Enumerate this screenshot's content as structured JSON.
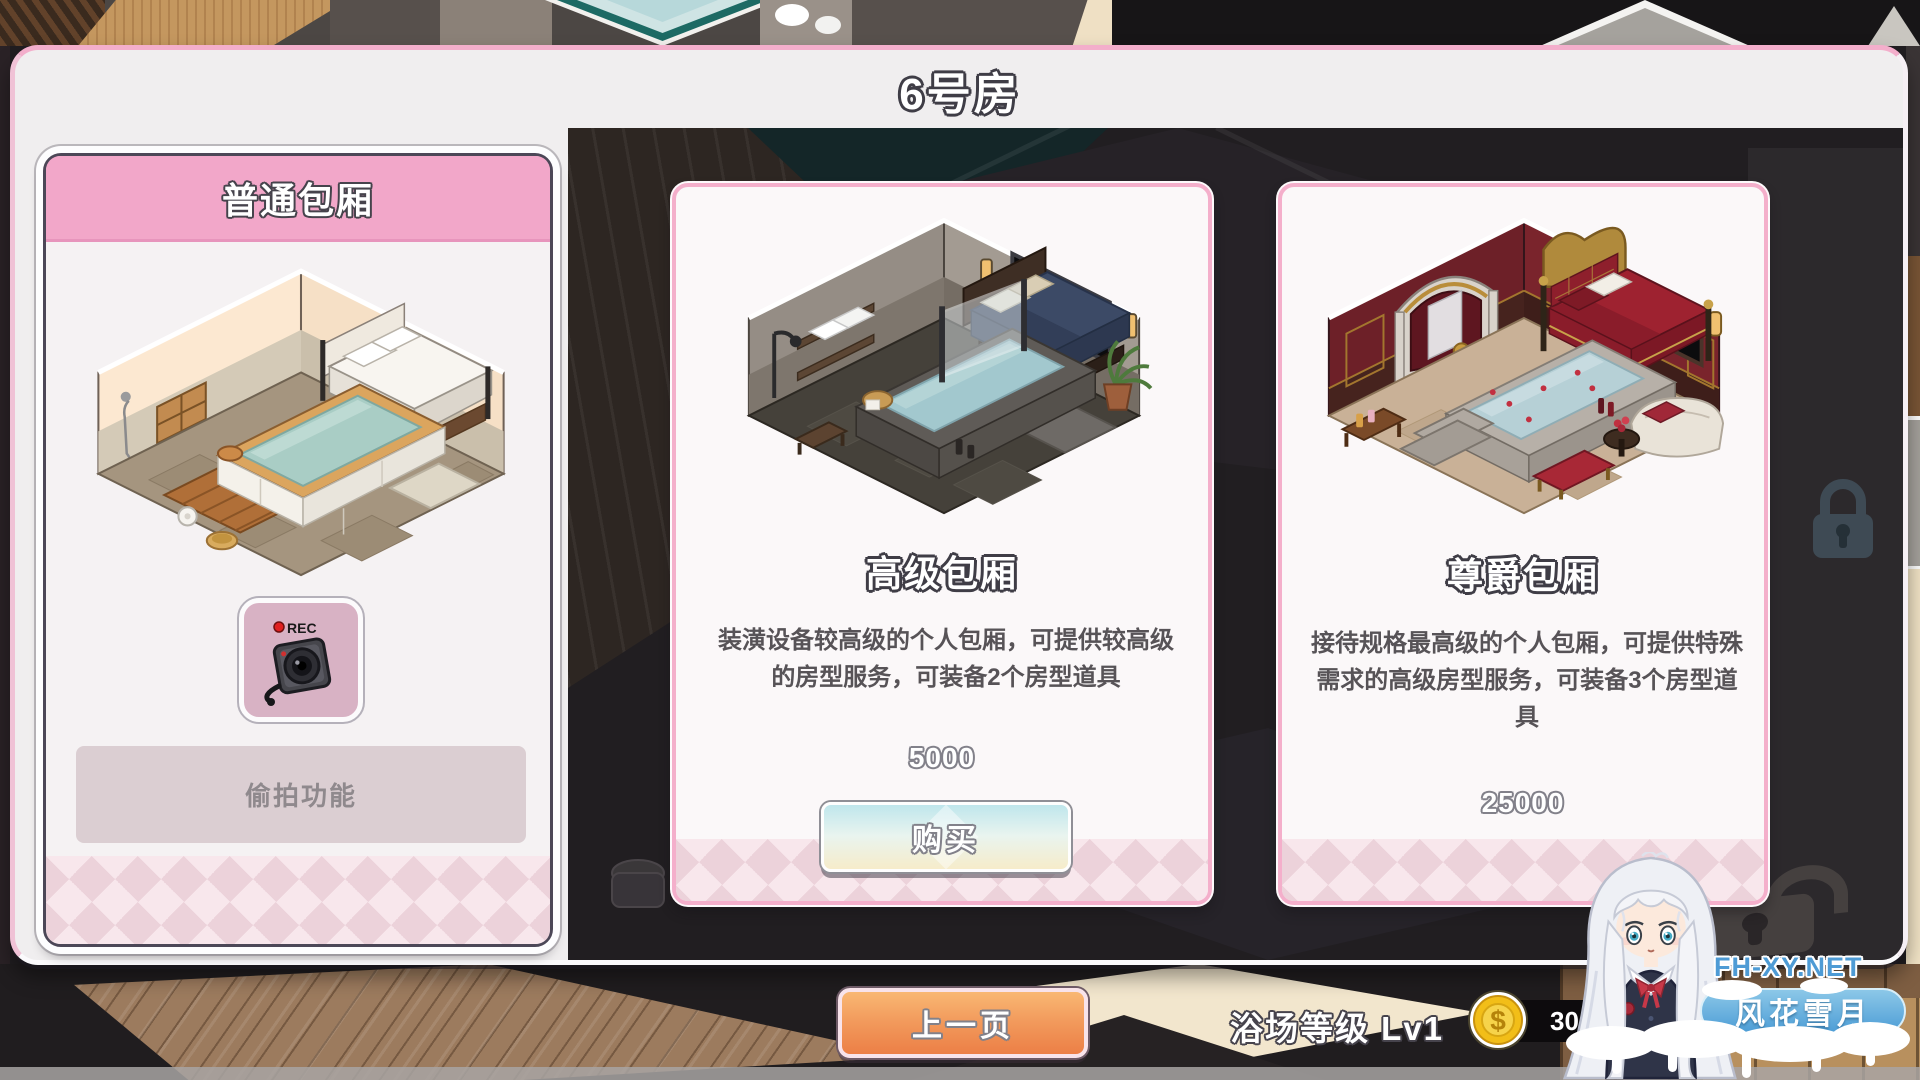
{
  "window": {
    "title": "6号房"
  },
  "cards": {
    "normal": {
      "title": "普通包厢",
      "feature": "偷拍功能",
      "camera_rec": "REC"
    },
    "premium": {
      "title": "高级包厢",
      "description": "装潢设备较高级的个人包厢，可提供较高级的房型服务，可装备2个房型道具",
      "price": "5000",
      "buy": "购买"
    },
    "royal": {
      "title": "尊爵包厢",
      "description": "接待规格最高级的个人包厢，可提供特殊需求的高级房型服务，可装备3个房型道具",
      "price": "25000"
    }
  },
  "footer": {
    "prev": "上一页",
    "level": "浴场等级 Lv1",
    "coin_symbol": "$",
    "coins_visible": "30"
  },
  "watermark": {
    "site": "FH-XY.NET",
    "name": "风花雪月"
  },
  "colors": {
    "header_pink": "#f2a7c9",
    "card_border_pink": "#f4afcb",
    "dialog_bg": "#f0eeef",
    "buy_gradient_top": "#bfe6ec",
    "buy_gradient_bottom": "#f6ecca",
    "prev_orange": "#ee8a52",
    "coin_gold": "#f2c41e",
    "diamond_pink": "#ecd2da",
    "scene_dark": "#211e21"
  }
}
